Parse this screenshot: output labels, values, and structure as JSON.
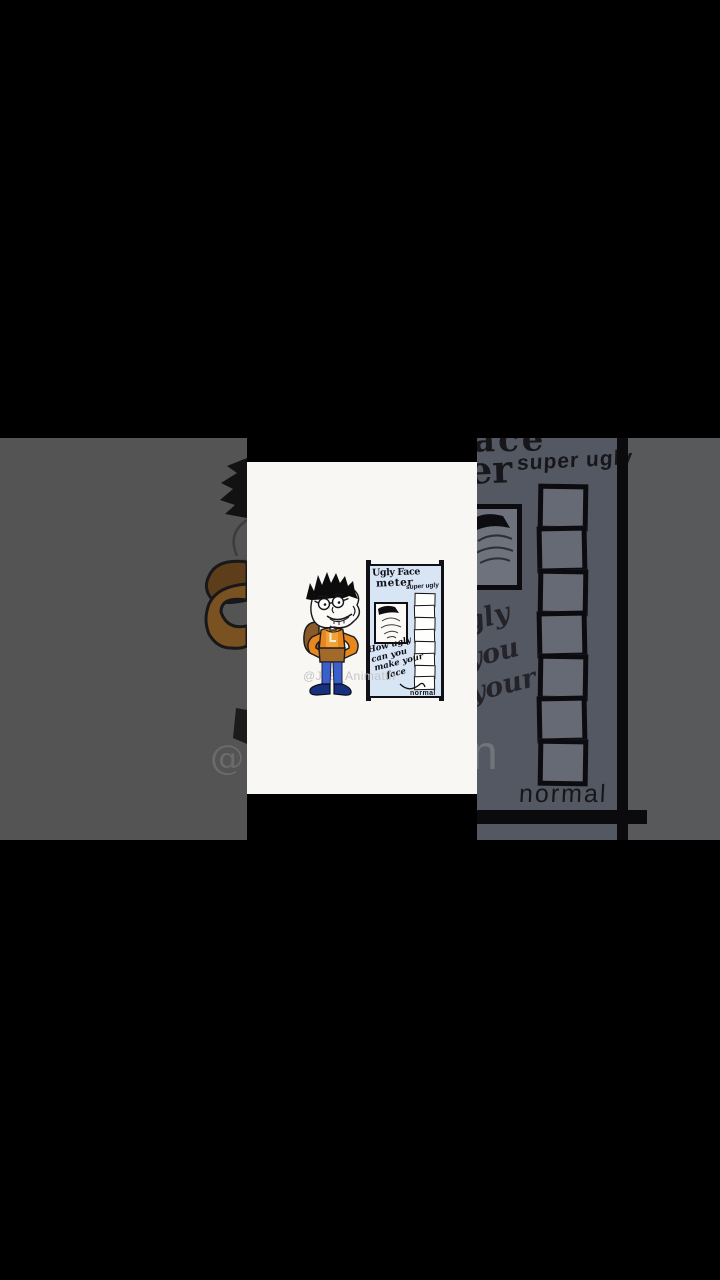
{
  "frame": {
    "watermark_handle": "@JLB_Animatin"
  },
  "card": {
    "sign": {
      "title_line1": "Ugly Face",
      "title_line2": "meter",
      "scale_top_label": "super ugly",
      "scale_bottom_label": "normal",
      "caption_lines": [
        "How ugly",
        "can you",
        "make your",
        "face"
      ],
      "meter_cell_count": 8
    }
  },
  "background_zoom": {
    "title_fragment_line1": "ace",
    "title_fragment_line2": "er",
    "scale_top_label": "super ugly",
    "scale_bottom_label": "normal",
    "caption_fragments": [
      "gly",
      "you",
      "your"
    ],
    "watermark_fragment_left": "@",
    "watermark_fragment_right": "n",
    "meter_cell_count": 7
  },
  "colors": {
    "stage-bg": "#000000",
    "bg-left": "#555454",
    "bg-right": "#545862",
    "bg-right-outer": "#58595b",
    "bg-ink": "#17171b",
    "bg-dim-cell": "#666a74",
    "bg-brown": "#7a5222",
    "bg-brown-dark": "#5e3d1a",
    "bg-frame-fill": "#6e727c",
    "bg-wm": "#85878c",
    "card-bg": "#f8f7f4",
    "panel-blue": "#d8e5f5",
    "ink": "#121218",
    "shirt": "#e8871e",
    "shirt-light": "#f2a338",
    "waist": "#a26a2a",
    "strap": "#8a5a28",
    "jeans": "#3c5fce",
    "shoe": "#18317f",
    "wm-gray": "#c4c4c4"
  }
}
